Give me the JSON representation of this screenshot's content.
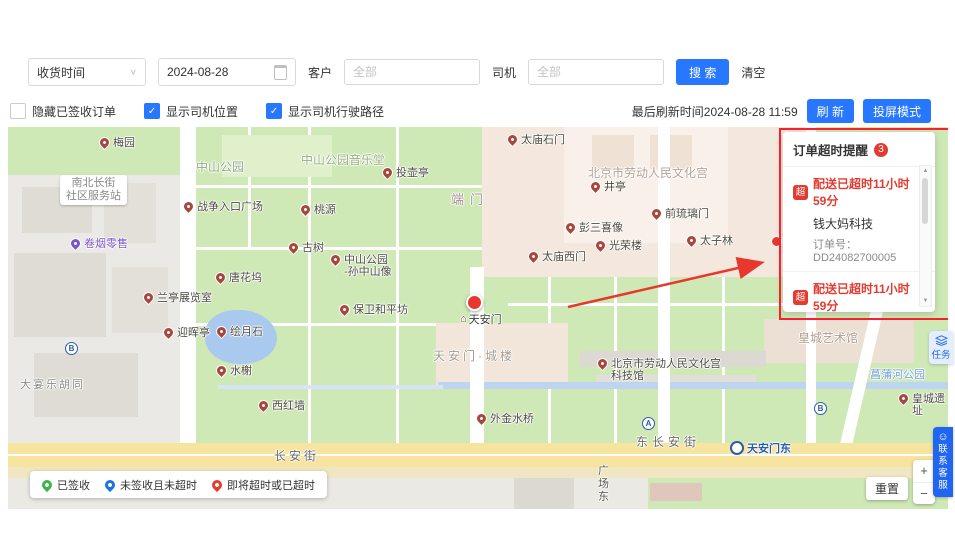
{
  "colors": {
    "primary": "#2878ff",
    "danger": "#e8382d",
    "annotation": "#f5222d"
  },
  "toolbar": {
    "time_type": "收货时间",
    "date": "2024-08-28",
    "customer_label": "客户",
    "customer_placeholder": "全部",
    "driver_label": "司机",
    "driver_placeholder": "全部",
    "search": "搜 索",
    "clear": "清空"
  },
  "filters": {
    "checkboxes": [
      {
        "label": "隐藏已签收订单",
        "checked": false
      },
      {
        "label": "显示司机位置",
        "checked": true
      },
      {
        "label": "显示司机行驶路径",
        "checked": true
      }
    ],
    "last_refresh": "最后刷新时间2024-08-28 11:59",
    "refresh": "刷 新",
    "cast_mode": "投屏模式"
  },
  "alert_panel": {
    "title": "订单超时提醒",
    "badge": "3",
    "items": [
      {
        "tag": "超",
        "status": "配送已超时11小时59分",
        "name": "钱大妈科技",
        "order_no": "订单号：DD24082700005"
      },
      {
        "tag": "超",
        "status": "配送已超时11小时59分",
        "name": "华润万家（科技园店）2",
        "order_no": "订单号：DD24082700003"
      },
      {
        "tag": "超",
        "status": "剩余0分",
        "name": "华润万家（科技园店）2",
        "order_no": ""
      }
    ]
  },
  "legend": [
    {
      "label": "已签收",
      "color": "#3bb54a"
    },
    {
      "label": "未签收且未超时",
      "color": "#1a73e8"
    },
    {
      "label": "即将超时或已超时",
      "color": "#e8382d"
    }
  ],
  "map_controls": {
    "reset": "重置",
    "zoom_in": "+",
    "zoom_out": "−"
  },
  "side_tabs": {
    "task": "任务",
    "service": "联\n系\n客\n服"
  },
  "map": {
    "selected_marker_label": "天安门",
    "metro": {
      "text": "天安门东",
      "x": 722,
      "y": 313
    },
    "pois": [
      {
        "text": "梅园",
        "x": 92,
        "y": 10
      },
      {
        "text": "战争入口广场",
        "x": 176,
        "y": 74
      },
      {
        "text": "桃源",
        "x": 293,
        "y": 77
      },
      {
        "text": "投壶亭",
        "x": 375,
        "y": 40
      },
      {
        "text": "太庙石门",
        "x": 500,
        "y": 7
      },
      {
        "text": "井亭",
        "x": 583,
        "y": 54
      },
      {
        "text": "前琉璃门",
        "x": 644,
        "y": 81
      },
      {
        "text": "彭三喜像",
        "x": 558,
        "y": 95
      },
      {
        "text": "光荣楼",
        "x": 588,
        "y": 113
      },
      {
        "text": "太子林",
        "x": 679,
        "y": 108
      },
      {
        "text": "太庙西门",
        "x": 521,
        "y": 124
      },
      {
        "text": "古树",
        "x": 281,
        "y": 115
      },
      {
        "text": "中山公园\n-孙中山像",
        "x": 323,
        "y": 127
      },
      {
        "text": "唐花坞",
        "x": 208,
        "y": 145
      },
      {
        "text": "兰亭展览室",
        "x": 136,
        "y": 165
      },
      {
        "text": "保卫和平坊",
        "x": 332,
        "y": 177
      },
      {
        "text": "迎晖亭",
        "x": 156,
        "y": 200
      },
      {
        "text": "绘月石",
        "x": 209,
        "y": 199
      },
      {
        "text": "水榭",
        "x": 209,
        "y": 238
      },
      {
        "text": "西红墙",
        "x": 251,
        "y": 273
      },
      {
        "text": "外金水桥",
        "x": 469,
        "y": 286
      },
      {
        "text": "北京市劳动人民文化宫\n科技馆",
        "x": 590,
        "y": 231
      },
      {
        "text": "皇城遗址",
        "x": 891,
        "y": 266
      },
      {
        "text": "卷烟零售",
        "x": 63,
        "y": 111,
        "pin": "#7c55c7",
        "tc": "#7c55c7"
      }
    ],
    "areas": [
      {
        "text": "中山公园",
        "x": 188,
        "y": 34,
        "color": "#8fa981",
        "size": 12
      },
      {
        "text": "中山公园音乐堂",
        "x": 293,
        "y": 27,
        "color": "#96b07e",
        "size": 12
      },
      {
        "text": "端门",
        "x": 443,
        "y": 66,
        "color": "#a39289",
        "size": 13,
        "sp": 6
      },
      {
        "text": "北京市劳动人民文化宫",
        "x": 580,
        "y": 40,
        "color": "#b3a29a",
        "size": 12
      },
      {
        "text": "天安门·城楼",
        "x": 425,
        "y": 223,
        "color": "#a39b90",
        "size": 12,
        "sp": 3
      },
      {
        "text": "皇城艺术馆",
        "x": 790,
        "y": 205,
        "color": "#b39a8c",
        "size": 12
      },
      {
        "text": "菖蒲河公园",
        "x": 862,
        "y": 242,
        "color": "#6f9fd8",
        "size": 11
      },
      {
        "text": "南北长街\n社区服务站",
        "x": 52,
        "y": 48,
        "color": "#8a8a8a",
        "size": 11,
        "bubble": true
      },
      {
        "text": "大宴乐胡同",
        "x": 12,
        "y": 252,
        "color": "#8a8a8a",
        "size": 11,
        "sp": 2
      },
      {
        "text": "东长安街",
        "x": 628,
        "y": 309,
        "color": "#6b6b63",
        "size": 12,
        "sp": 4
      },
      {
        "text": "长安街",
        "x": 266,
        "y": 323,
        "color": "#6b6b63",
        "size": 12,
        "sp": 3
      },
      {
        "text": "广\n场\n东",
        "x": 590,
        "y": 338,
        "color": "#55554d",
        "size": 11
      }
    ],
    "badges": [
      {
        "t": "A",
        "x": 634,
        "y": 290
      },
      {
        "t": "B",
        "x": 806,
        "y": 275
      },
      {
        "t": "B",
        "x": 57,
        "y": 215
      }
    ]
  }
}
